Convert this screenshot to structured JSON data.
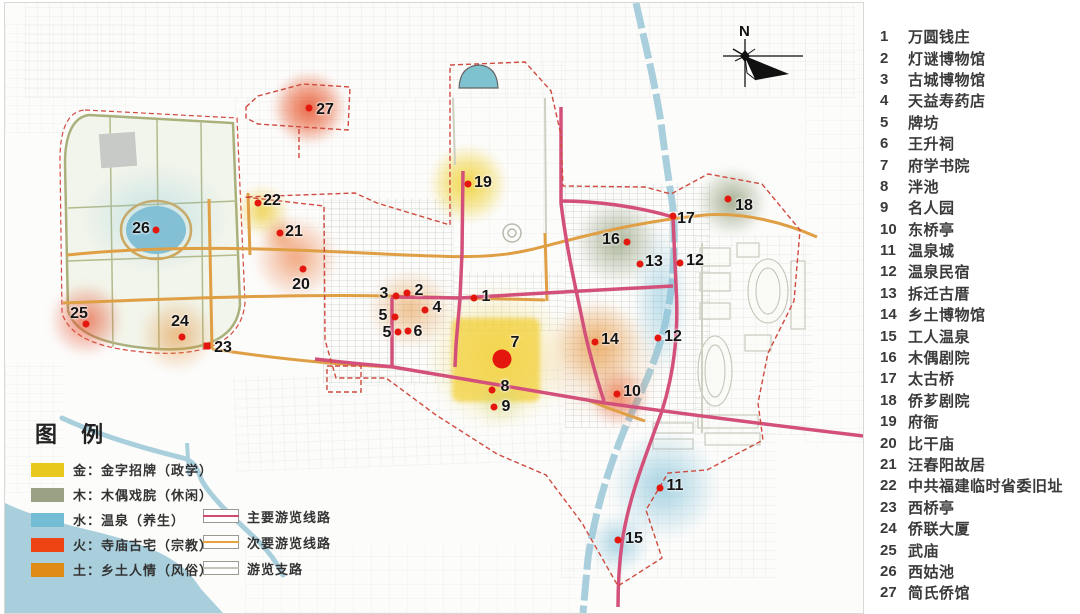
{
  "map": {
    "markers": [
      {
        "n": "1",
        "x": 469,
        "y": 295,
        "lx": 481,
        "ly": 294
      },
      {
        "n": "2",
        "x": 402,
        "y": 290,
        "lx": 414,
        "ly": 288
      },
      {
        "n": "3",
        "x": 391,
        "y": 293,
        "lx": 379,
        "ly": 291
      },
      {
        "n": "4",
        "x": 420,
        "y": 307,
        "lx": 432,
        "ly": 305
      },
      {
        "n": "5",
        "x": 390,
        "y": 314,
        "lx": 378,
        "ly": 313
      },
      {
        "n": "5",
        "x": 393,
        "y": 329,
        "lx": 382,
        "ly": 330
      },
      {
        "n": "6",
        "x": 403,
        "y": 328,
        "lx": 413,
        "ly": 329
      },
      {
        "n": "7",
        "x": 497,
        "y": 356,
        "lx": 510,
        "ly": 340,
        "big": true
      },
      {
        "n": "8",
        "x": 487,
        "y": 387,
        "lx": 500,
        "ly": 384
      },
      {
        "n": "9",
        "x": 489,
        "y": 404,
        "lx": 501,
        "ly": 404
      },
      {
        "n": "10",
        "x": 612,
        "y": 391,
        "lx": 627,
        "ly": 389
      },
      {
        "n": "11",
        "x": 655,
        "y": 485,
        "lx": 670,
        "ly": 483
      },
      {
        "n": "12",
        "x": 675,
        "y": 260,
        "lx": 690,
        "ly": 258
      },
      {
        "n": "12",
        "x": 653,
        "y": 335,
        "lx": 668,
        "ly": 334
      },
      {
        "n": "13",
        "x": 635,
        "y": 261,
        "lx": 649,
        "ly": 259
      },
      {
        "n": "14",
        "x": 590,
        "y": 339,
        "lx": 605,
        "ly": 337
      },
      {
        "n": "15",
        "x": 613,
        "y": 537,
        "lx": 629,
        "ly": 536
      },
      {
        "n": "16",
        "x": 622,
        "y": 239,
        "lx": 606,
        "ly": 237
      },
      {
        "n": "17",
        "x": 668,
        "y": 213,
        "lx": 681,
        "ly": 216
      },
      {
        "n": "18",
        "x": 723,
        "y": 196,
        "lx": 739,
        "ly": 203
      },
      {
        "n": "19",
        "x": 463,
        "y": 181,
        "lx": 478,
        "ly": 180
      },
      {
        "n": "20",
        "x": 298,
        "y": 266,
        "lx": 296,
        "ly": 282
      },
      {
        "n": "21",
        "x": 275,
        "y": 230,
        "lx": 289,
        "ly": 229
      },
      {
        "n": "22",
        "x": 253,
        "y": 200,
        "lx": 267,
        "ly": 198
      },
      {
        "n": "23",
        "x": 202,
        "y": 343,
        "lx": 218,
        "ly": 345,
        "square": true
      },
      {
        "n": "24",
        "x": 177,
        "y": 334,
        "lx": 175,
        "ly": 319
      },
      {
        "n": "25",
        "x": 81,
        "y": 321,
        "lx": 74,
        "ly": 311
      },
      {
        "n": "26",
        "x": 151,
        "y": 227,
        "lx": 136,
        "ly": 226
      },
      {
        "n": "27",
        "x": 304,
        "y": 105,
        "lx": 320,
        "ly": 107
      }
    ],
    "marker_color": "#e3170d",
    "boundary_color": "#cf4a3f",
    "water_color": "#a9cfdd"
  },
  "legend": {
    "title": "图 例",
    "categories": [
      {
        "label": "金：金字招牌（政学）",
        "color": "#e9c81e"
      },
      {
        "label": "木：木偶戏脘（休闲）",
        "color": "#9aa184"
      },
      {
        "label": "水：温泉（养生）",
        "color": "#74bcd4"
      },
      {
        "label": "火：寺庙古宅（宗教）",
        "color": "#ee4413"
      },
      {
        "label": "土：乡土人情（风俗）",
        "color": "#e08a18"
      }
    ],
    "routes": [
      {
        "label": "主要游览线路",
        "color": "#d14b6e"
      },
      {
        "label": "次要游览线路",
        "color": "#e8a33d"
      },
      {
        "label": "游览支路",
        "color": "#c5c5b5"
      }
    ]
  },
  "compass": {
    "label": "N"
  },
  "poi_list": [
    {
      "num": "1",
      "name": "万圆钱庄"
    },
    {
      "num": "2",
      "name": "灯谜博物馆"
    },
    {
      "num": "3",
      "name": "古城博物馆"
    },
    {
      "num": "4",
      "name": "天益寿药店"
    },
    {
      "num": "5",
      "name": "牌坊"
    },
    {
      "num": "6",
      "name": "王升祠"
    },
    {
      "num": "7",
      "name": "府学书院"
    },
    {
      "num": "8",
      "name": "泮池"
    },
    {
      "num": "9",
      "name": "名人园"
    },
    {
      "num": "10",
      "name": "东桥亭"
    },
    {
      "num": "11",
      "name": "温泉城"
    },
    {
      "num": "12",
      "name": "温泉民宿"
    },
    {
      "num": "13",
      "name": "拆迁古厝"
    },
    {
      "num": "14",
      "name": "乡土博物馆"
    },
    {
      "num": "15",
      "name": "工人温泉"
    },
    {
      "num": "16",
      "name": "木偶剧院"
    },
    {
      "num": "17",
      "name": "太古桥"
    },
    {
      "num": "18",
      "name": "侨芗剧院"
    },
    {
      "num": "19",
      "name": "府衙"
    },
    {
      "num": "20",
      "name": "比干庙"
    },
    {
      "num": "21",
      "name": "汪春阳故居"
    },
    {
      "num": "22",
      "name": "中共福建临时省委旧址"
    },
    {
      "num": "23",
      "name": "西桥亭"
    },
    {
      "num": "24",
      "name": "侨联大厦"
    },
    {
      "num": "25",
      "name": "武庙"
    },
    {
      "num": "26",
      "name": "西姑池"
    },
    {
      "num": "27",
      "name": "简氏侨馆"
    }
  ]
}
